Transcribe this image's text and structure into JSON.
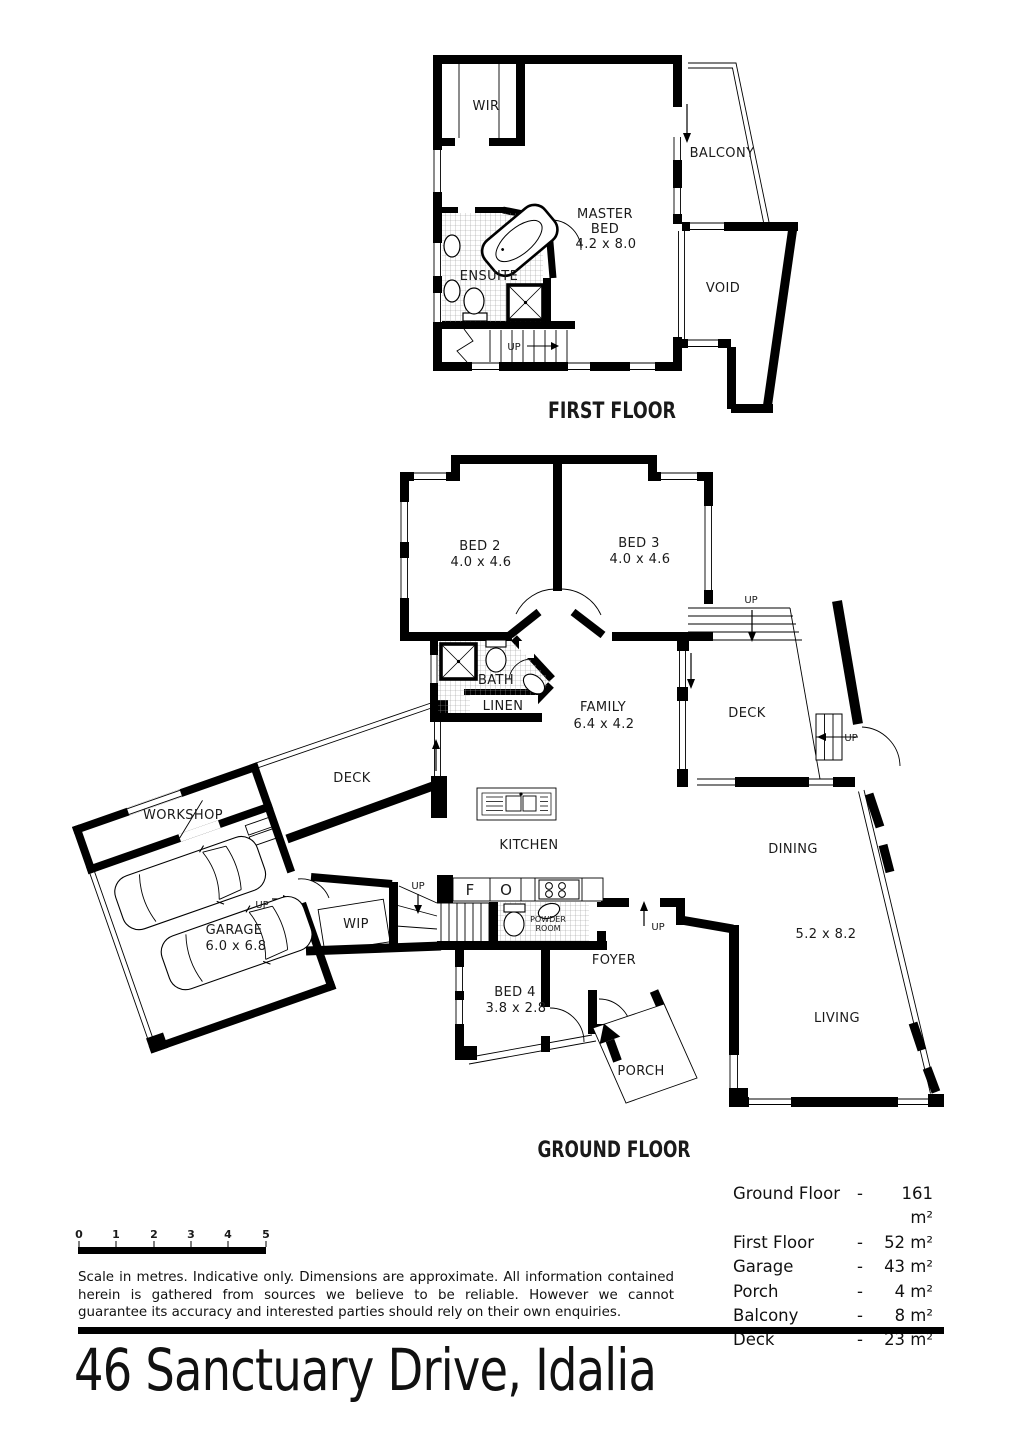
{
  "title": "46 Sanctuary Drive, Idalia",
  "labels": {
    "up": "UP"
  },
  "first_floor": {
    "name": "FIRST FLOOR",
    "wir": "WIR",
    "balcony": "BALCONY",
    "master": {
      "l1": "MASTER",
      "l2": "BED",
      "dims": "4.2 x 8.0"
    },
    "ensuite": "ENSUITE",
    "void": "VOID"
  },
  "ground_floor": {
    "name": "GROUND FLOOR",
    "bed2": {
      "name": "BED 2",
      "dims": "4.0 x 4.6"
    },
    "bed3": {
      "name": "BED 3",
      "dims": "4.0 x 4.6"
    },
    "bed4": {
      "name": "BED 4",
      "dims": "3.8 x 2.8"
    },
    "bath": "BATH",
    "linen": "LINEN",
    "family": {
      "name": "FAMILY",
      "dims": "6.4 x 4.2"
    },
    "deck_right": "DECK",
    "deck_left": "DECK",
    "workshop": "WORKSHOP",
    "garage": {
      "name": "GARAGE",
      "dims": "6.0 x 6.8"
    },
    "wip": "WIP",
    "kitchen": "KITCHEN",
    "fridge": "F",
    "oven": "O",
    "powder": {
      "l1": "POWDER",
      "l2": "ROOM"
    },
    "foyer": "FOYER",
    "porch": "PORCH",
    "dining": "DINING",
    "living": {
      "name": "LIVING",
      "dims": "5.2 x 8.2"
    }
  },
  "scale_bar": {
    "ticks": [
      "0",
      "1",
      "2",
      "3",
      "4",
      "5"
    ]
  },
  "disclaimer": "Scale in metres. Indicative only. Dimensions are approximate.  All information contained herein is gathered from sources we believe to be reliable. However we cannot guarantee its accuracy and interested parties should rely on their own enquiries.",
  "areas": {
    "rows": [
      {
        "label": "Ground Floor",
        "sep": "-",
        "value": "161 m²"
      },
      {
        "label": "First Floor",
        "sep": "-",
        "value": "52 m²"
      },
      {
        "label": "Garage",
        "sep": "-",
        "value": "43 m²"
      },
      {
        "label": "Porch",
        "sep": "-",
        "value": "4 m²"
      },
      {
        "label": "Balcony",
        "sep": "-",
        "value": "8 m²"
      },
      {
        "label": "Deck",
        "sep": "-",
        "value": "23 m²"
      }
    ]
  }
}
